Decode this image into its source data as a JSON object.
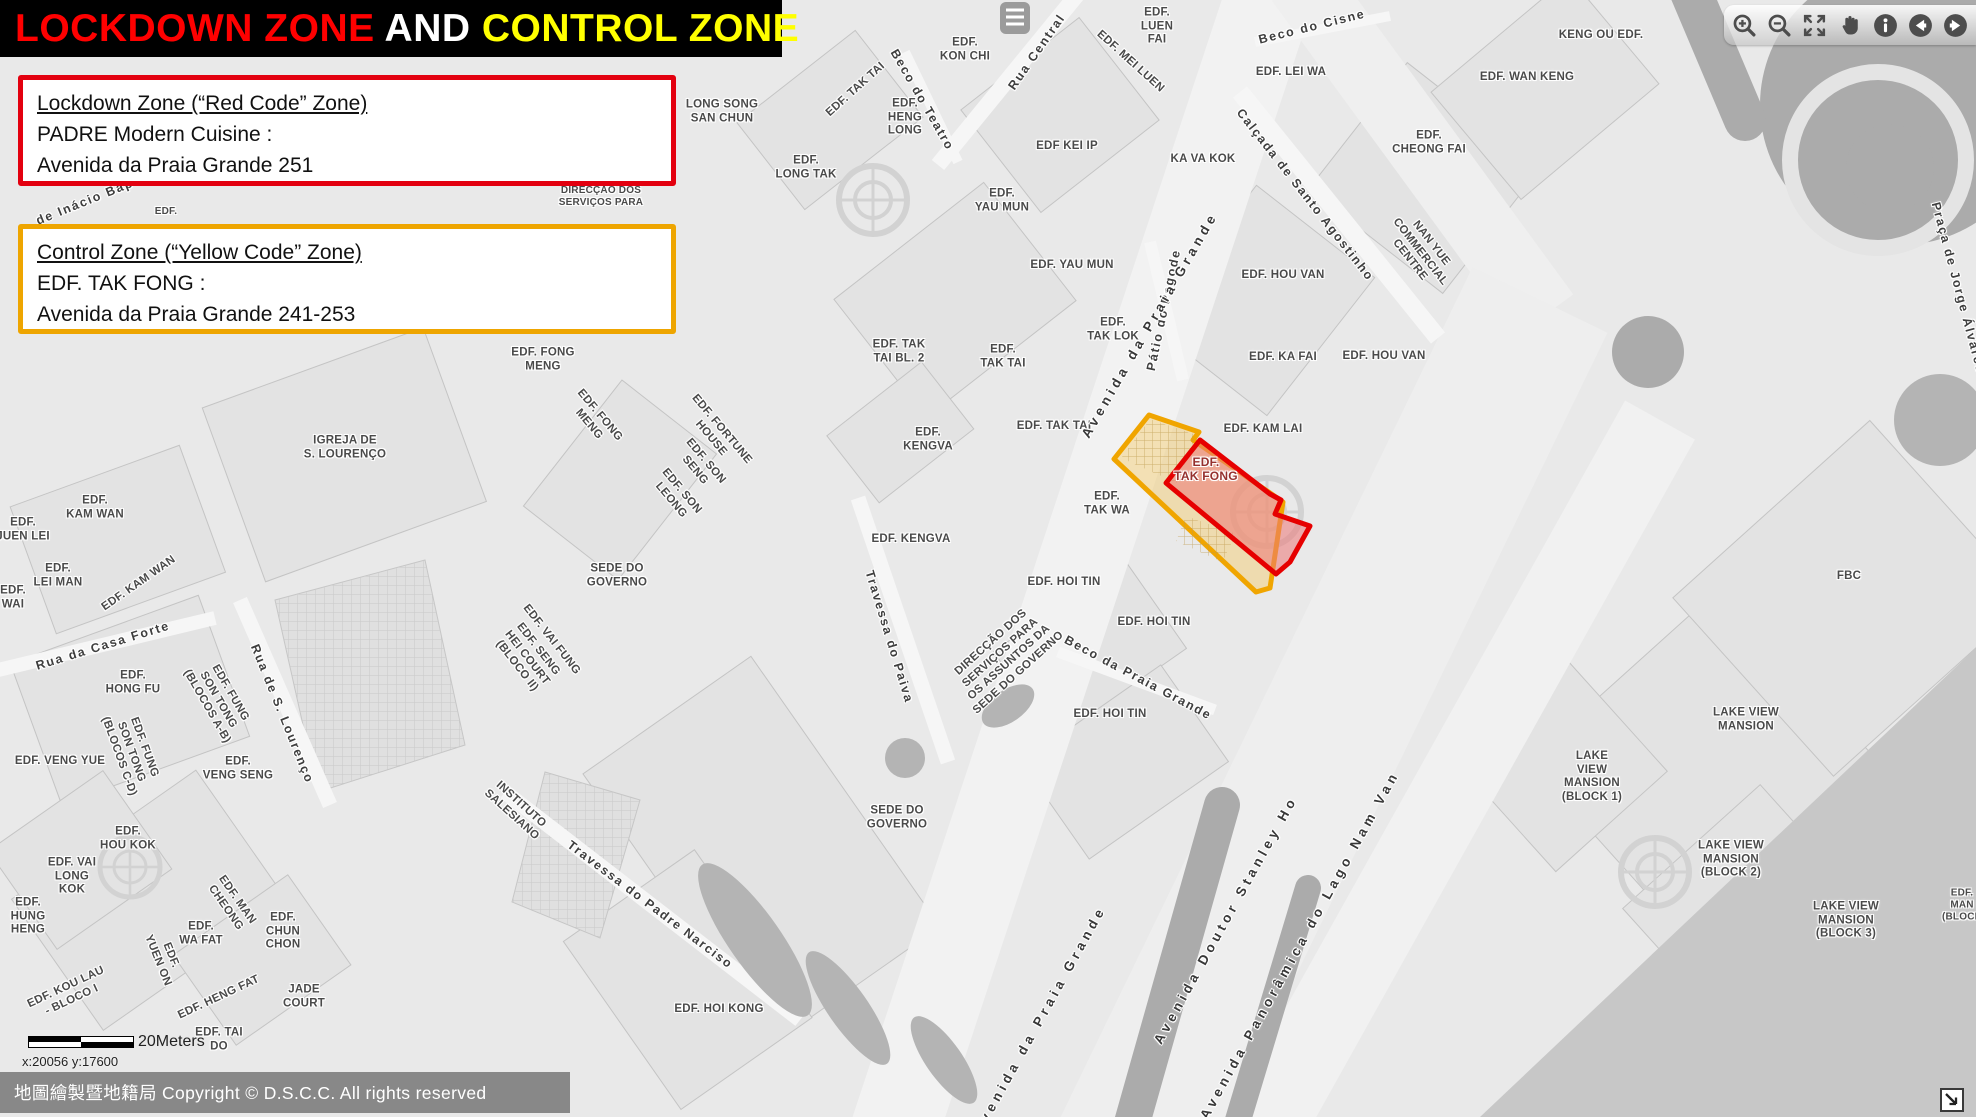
{
  "title": {
    "part1": "LOCKDOWN ZONE",
    "part2": " AND ",
    "part3": "CONTROL ZONE"
  },
  "legend": {
    "lockdown": {
      "heading": "Lockdown Zone (“Red Code” Zone)",
      "line1": "PADRE Modern Cuisine :",
      "line2": "Avenida da Praia Grande 251",
      "border_color": "#e3000f"
    },
    "control": {
      "heading": "Control Zone (“Yellow Code” Zone)",
      "line1": "EDF. TAK FONG :",
      "line2": "Avenida da Praia Grande 241-253",
      "border_color": "#eea500"
    }
  },
  "toolbar": {
    "buttons": [
      "zoom-in",
      "zoom-out",
      "full-extent",
      "pan",
      "identify",
      "previous-extent",
      "next-extent"
    ]
  },
  "map": {
    "zones": {
      "control": {
        "name": "control-zone",
        "stroke": "#f0a500",
        "fill": "rgba(243,205,117,0.5)"
      },
      "lockdown": {
        "name": "lockdown-zone",
        "stroke": "#e60000",
        "fill": "rgba(236,118,118,0.55)"
      }
    },
    "scale_bar": {
      "label": "20Meters"
    },
    "coordinates": "x:20056 y:17600",
    "copyright": "地圖繪製暨地籍局 Copyright © D.S.C.C. All rights reserved",
    "labels": [
      {
        "t": "EDF.\nKON CHI",
        "x": 965,
        "y": 50
      },
      {
        "t": "LONG SONG\nSAN CHUN",
        "x": 722,
        "y": 112
      },
      {
        "t": "EDF.\nHENG\nLONG",
        "x": 905,
        "y": 118
      },
      {
        "t": "EDF. TAK TAI",
        "x": 856,
        "y": 90,
        "r": -42
      },
      {
        "t": "Beco do Teatro",
        "x": 922,
        "y": 100,
        "r": 60,
        "c": "s"
      },
      {
        "t": "EDF.\nLONG TAK",
        "x": 806,
        "y": 168
      },
      {
        "t": "Rua Central",
        "x": 1037,
        "y": 52,
        "r": -55,
        "c": "s"
      },
      {
        "t": "EDF.\nLUEN\nFAI",
        "x": 1157,
        "y": 27
      },
      {
        "t": "EDF. MEI LUEN",
        "x": 1130,
        "y": 62,
        "r": 42
      },
      {
        "t": "Beco do Cisne",
        "x": 1312,
        "y": 27,
        "r": -14,
        "c": "s"
      },
      {
        "t": "EDF. LEI WA",
        "x": 1291,
        "y": 73
      },
      {
        "t": "EDF KEI IP",
        "x": 1067,
        "y": 147
      },
      {
        "t": "KA VA KOK",
        "x": 1203,
        "y": 160
      },
      {
        "t": "EDF.\nYAU MUN",
        "x": 1002,
        "y": 201
      },
      {
        "t": "EDF. YAU MUN",
        "x": 1072,
        "y": 266
      },
      {
        "t": "Calçada de Santo Agostinho",
        "x": 1305,
        "y": 195,
        "r": 52,
        "c": "s"
      },
      {
        "t": "EDF. HOU VAN",
        "x": 1283,
        "y": 276
      },
      {
        "t": "Pátio do Pagode",
        "x": 1164,
        "y": 310,
        "r": -78,
        "c": "s"
      },
      {
        "t": "EDF.\nTAK LOK",
        "x": 1113,
        "y": 330
      },
      {
        "t": "EDF.\nTAK TAI",
        "x": 1003,
        "y": 357
      },
      {
        "t": "EDF. TAK\nTAI BL. 2",
        "x": 899,
        "y": 352
      },
      {
        "t": "EDF. KA FAI",
        "x": 1283,
        "y": 358
      },
      {
        "t": "EDF. HOU VAN",
        "x": 1384,
        "y": 357
      },
      {
        "t": "EDF. TAK TAI",
        "x": 1054,
        "y": 427
      },
      {
        "t": "EDF. KAM LAI",
        "x": 1263,
        "y": 430
      },
      {
        "t": "EDF.\nKENGVA",
        "x": 928,
        "y": 440
      },
      {
        "t": "NAN YUE\nCOMMERCIAL\nCENTRE",
        "x": 1420,
        "y": 252,
        "r": 52
      },
      {
        "t": "Avenida da Praia Grande",
        "x": 1150,
        "y": 325,
        "r": -60,
        "c": "sb"
      },
      {
        "t": "EDF.\nTAK FONG",
        "x": 1206,
        "y": 469,
        "c": "zr"
      },
      {
        "t": "EDF.\nTAK WA",
        "x": 1107,
        "y": 504
      },
      {
        "t": "EDF. KENGVA",
        "x": 911,
        "y": 540
      },
      {
        "t": "EDF. HOI TIN",
        "x": 1064,
        "y": 583
      },
      {
        "t": "EDF. HOI TIN",
        "x": 1154,
        "y": 623
      },
      {
        "t": "DIRECÇÃO DOS\nSERVIÇOS PARA\nOS ASSUNTOS DA\nSEDE DO GOVERNO",
        "x": 1005,
        "y": 658,
        "r": -42
      },
      {
        "t": "Beco da Praia Grande",
        "x": 1138,
        "y": 678,
        "r": 28,
        "c": "s"
      },
      {
        "t": "EDF. HOI TIN",
        "x": 1110,
        "y": 715
      },
      {
        "t": "Travessa do Paiva",
        "x": 889,
        "y": 637,
        "r": 73,
        "c": "s"
      },
      {
        "t": "SEDE DO\nGOVERNO",
        "x": 617,
        "y": 576
      },
      {
        "t": "SEDE DO\nGOVERNO",
        "x": 897,
        "y": 818
      },
      {
        "t": "EDF. HOI KONG",
        "x": 719,
        "y": 1010
      },
      {
        "t": "IGREJA DE\nS. LOURENÇO",
        "x": 345,
        "y": 448
      },
      {
        "t": "EDF. FONG\nMENG",
        "x": 543,
        "y": 360
      },
      {
        "t": "EDF. FONG\nMENG",
        "x": 594,
        "y": 420,
        "r": 50
      },
      {
        "t": "EDF. FORTUNE\nHOUSE",
        "x": 716,
        "y": 434,
        "r": 50
      },
      {
        "t": "EDF. SON\nSENG",
        "x": 700,
        "y": 466,
        "r": 50
      },
      {
        "t": "EDF. SON\nLEONG",
        "x": 676,
        "y": 496,
        "r": 50
      },
      {
        "t": "EDF. VAI FUNG",
        "x": 551,
        "y": 640,
        "r": 52
      },
      {
        "t": "EDF. SENG\nHEI COURT\n(BLOCO II)",
        "x": 527,
        "y": 658,
        "r": 52
      },
      {
        "t": "INSTITUTO\nSALESIANO",
        "x": 516,
        "y": 810,
        "r": 42
      },
      {
        "t": "Travessa do Padre Narciso",
        "x": 650,
        "y": 905,
        "r": 37,
        "c": "s"
      },
      {
        "t": "EDF.\nKAM WAN",
        "x": 95,
        "y": 508
      },
      {
        "t": "EDF.\nJUEN LEI",
        "x": 23,
        "y": 530
      },
      {
        "t": "EDF.\nLEI MAN",
        "x": 58,
        "y": 576
      },
      {
        "t": "EDF.\nWAI",
        "x": 13,
        "y": 598
      },
      {
        "t": "EDF. KAM WAN",
        "x": 139,
        "y": 584,
        "r": -35
      },
      {
        "t": "Rua da Casa Forte",
        "x": 103,
        "y": 646,
        "r": -17,
        "c": "s"
      },
      {
        "t": "EDF.\nHONG FU",
        "x": 133,
        "y": 683
      },
      {
        "t": "EDF. FUNG\nSON TONG\n(BLOCOS A-B)",
        "x": 218,
        "y": 700,
        "r": 60
      },
      {
        "t": "EDF. VENG YUE",
        "x": 60,
        "y": 762
      },
      {
        "t": "EDF. FUNG\nSON TONG\n(BLOCOS C-D)",
        "x": 131,
        "y": 752,
        "r": 70
      },
      {
        "t": "Rua de S. Lourenço",
        "x": 282,
        "y": 714,
        "r": 68,
        "c": "s"
      },
      {
        "t": "EDF.\nVENG SENG",
        "x": 238,
        "y": 769
      },
      {
        "t": "EDF.\nHOU KOK",
        "x": 128,
        "y": 839
      },
      {
        "t": "EDF. VAI\nLONG\nKOK",
        "x": 72,
        "y": 877
      },
      {
        "t": "EDF.\nHUNG\nHENG",
        "x": 28,
        "y": 917
      },
      {
        "t": "EDF. KOU LAU\n- BLOCO I",
        "x": 69,
        "y": 994,
        "r": -25
      },
      {
        "t": "EDF.\nYUEN ON",
        "x": 164,
        "y": 958,
        "r": 68
      },
      {
        "t": "EDF.\nWA FAT",
        "x": 201,
        "y": 934
      },
      {
        "t": "EDF. MAN\nCHEONG",
        "x": 231,
        "y": 904,
        "r": 55
      },
      {
        "t": "EDF.\nCHUN\nCHON",
        "x": 283,
        "y": 932
      },
      {
        "t": "JADE\nCOURT",
        "x": 304,
        "y": 997
      },
      {
        "t": "EDF. HENG FAT",
        "x": 219,
        "y": 998,
        "r": -25
      },
      {
        "t": "EDF. TAI\nDO",
        "x": 219,
        "y": 1040
      },
      {
        "t": "KENG OU EDF.",
        "x": 1601,
        "y": 36
      },
      {
        "t": "EDF. WAN KENG",
        "x": 1527,
        "y": 78
      },
      {
        "t": "EDF.\nCHEONG FAI",
        "x": 1429,
        "y": 143
      },
      {
        "t": "Praça de Jorge Álvares",
        "x": 1958,
        "y": 288,
        "r": 75,
        "c": "s"
      },
      {
        "t": "FBC",
        "x": 1849,
        "y": 577
      },
      {
        "t": "LAKE VIEW\nMANSION",
        "x": 1746,
        "y": 720
      },
      {
        "t": "LAKE\nVIEW\nMANSION\n(BLOCK 1)",
        "x": 1592,
        "y": 777
      },
      {
        "t": "LAKE VIEW\nMANSION\n(BLOCK 2)",
        "x": 1731,
        "y": 860
      },
      {
        "t": "LAKE VIEW\nMANSION\n(BLOCK 3)",
        "x": 1846,
        "y": 921
      },
      {
        "t": "Avenida da Praia Grande",
        "x": 1040,
        "y": 1020,
        "r": -61,
        "c": "sb"
      },
      {
        "t": "Avenida Doutor Stanley Ho",
        "x": 1226,
        "y": 920,
        "r": -61,
        "c": "sb"
      },
      {
        "t": "Avenida Panorâmica do Lago Nam Van",
        "x": 1300,
        "y": 945,
        "r": -61,
        "c": "sb"
      },
      {
        "t": "DIRECÇÃO DOS\nSERVIÇOS PARA",
        "x": 601,
        "y": 197,
        "c": "sm"
      },
      {
        "t": "EDF.",
        "x": 166,
        "y": 212,
        "c": "sm"
      },
      {
        "t": "de Inácio Bap",
        "x": 85,
        "y": 202,
        "r": -22,
        "c": "s"
      },
      {
        "t": "EDF.\nMAN\n(BLOCK",
        "x": 1962,
        "y": 905,
        "c": "sm"
      }
    ]
  }
}
